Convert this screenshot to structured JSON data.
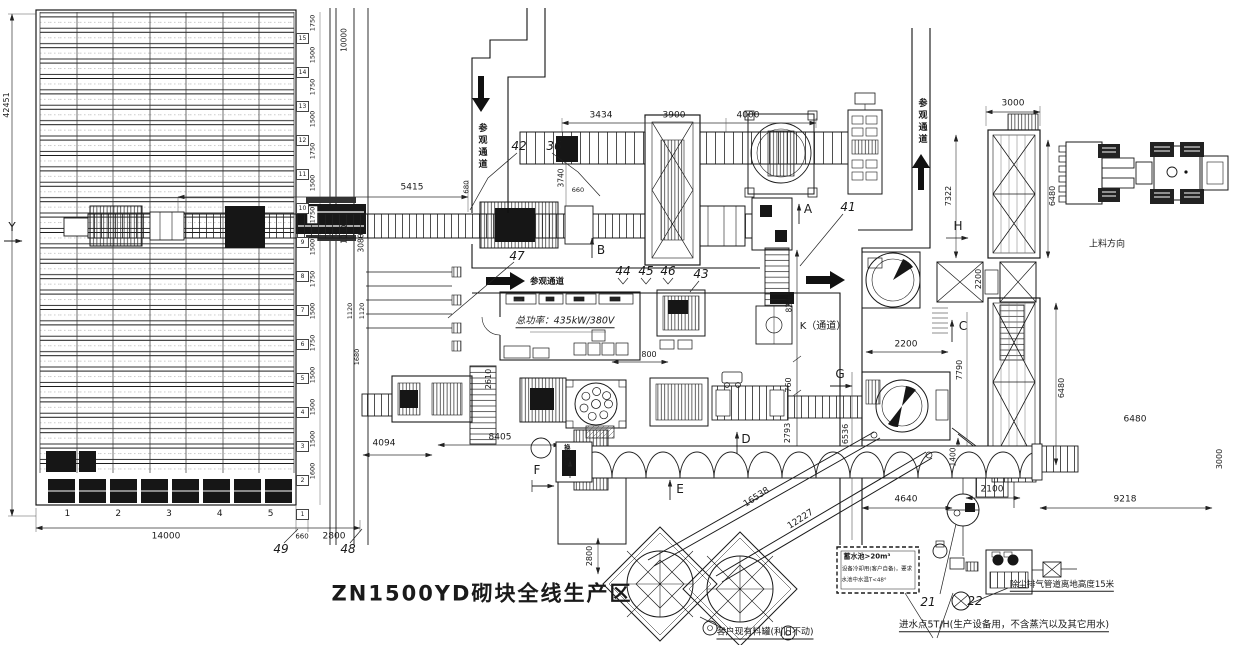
{
  "title": "ZN1500YD砌块全线生产区",
  "passage": "参观通道",
  "markers": {
    "y": "Y",
    "a": "A",
    "b": "B",
    "c": "C",
    "d": "D",
    "e": "E",
    "f": "F",
    "g": "G",
    "h": "H",
    "k": "K（通道）"
  },
  "notes": {
    "power": "总功率：435kW/380V",
    "loading": "上料方向",
    "mold_change": "换模位",
    "tank": "客户现有料罐(利旧不动)",
    "water1": "蓄水池>20m³",
    "water2": "设备冷却用(客户自备)，要求",
    "water3": "水池中水温T<48°",
    "dust": "除尘排气管道离地高度15米",
    "inlet": "进水点5T/H(生产设备用，不含蒸汽以及其它用水)"
  },
  "callouts": {
    "n21": "21",
    "n22": "22",
    "n36": "36",
    "n41": "41",
    "n42": "42",
    "n43": "43",
    "n44": "44",
    "n45": "45",
    "n46": "46",
    "n47": "47",
    "n48": "48",
    "n49": "49"
  },
  "dims": {
    "d42451": "42451",
    "d14000": "14000",
    "d660": "660",
    "d660b": "660",
    "d2800a": "2800",
    "d2800b": "2800",
    "d10000a": "10000",
    "d10000b": "10000",
    "d3080": "3080",
    "d1120a": "1120",
    "d1120b": "1120",
    "d1680": "1680",
    "d5415": "5415",
    "d680": "680",
    "d3740": "3740",
    "d3434": "3434",
    "d3900": "3900",
    "d4000": "4000",
    "d8240": "8240",
    "d760": "760",
    "d2793": "2793",
    "d800": "800",
    "d2610": "2610",
    "d8405": "8405",
    "d4094": "4094",
    "d6536": "6536",
    "d4640": "4640",
    "d2100": "2100",
    "d1400": "1400",
    "d7790": "7790",
    "d2200a": "2200",
    "d2200b": "2200",
    "d3000a": "3000",
    "d3000b": "3000",
    "d7322": "7322",
    "d6480a": "6480",
    "d6480b": "6480",
    "d6480c": "6480",
    "d9218": "9218",
    "d16538": "16538",
    "d12227": "12227"
  },
  "rack": {
    "columns": [
      "1",
      "2",
      "3",
      "4",
      "5"
    ],
    "row_numbers": [
      "15",
      "14",
      "13",
      "12",
      "11",
      "10",
      "9",
      "8",
      "7",
      "6",
      "5",
      "4",
      "3",
      "2",
      "1"
    ],
    "chain": [
      "1750",
      "1500",
      "1750",
      "1500",
      "1750",
      "1500",
      "1750",
      "1500",
      "1750",
      "1500",
      "1750",
      "1500",
      "1500",
      "1500",
      "1600"
    ]
  }
}
